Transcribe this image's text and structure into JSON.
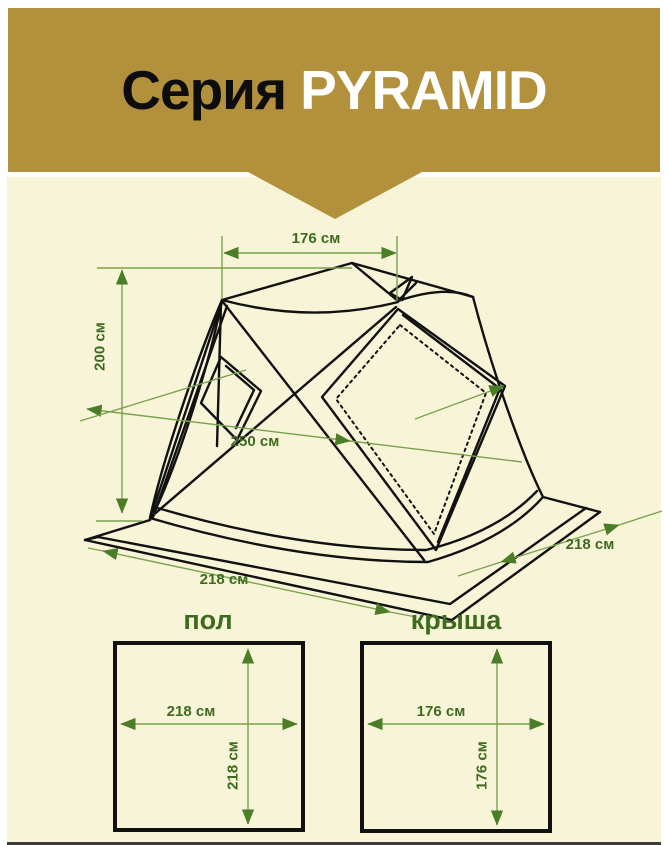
{
  "title": {
    "series_label": "Серия",
    "name": "PYRAMID"
  },
  "colors": {
    "banner_gold": "#b2903c",
    "background_cream": "#f7f4d8",
    "dimension_text_green": "#3e6b1e",
    "dimension_line_green": "#7aa24e",
    "arrowhead_green": "#4a7d25",
    "drawing_black": "#111111"
  },
  "tent_diagram": {
    "dim_top_width": "176 см",
    "dim_height": "200 см",
    "dim_diagonal": "250 см",
    "dim_base_left": "218 см",
    "dim_base_right": "218 см"
  },
  "floor_panel": {
    "label": "пол",
    "dim_width": "218 см",
    "dim_height": "218 см"
  },
  "roof_panel": {
    "label": "крыша",
    "dim_width": "176 см",
    "dim_height": "176 см"
  }
}
